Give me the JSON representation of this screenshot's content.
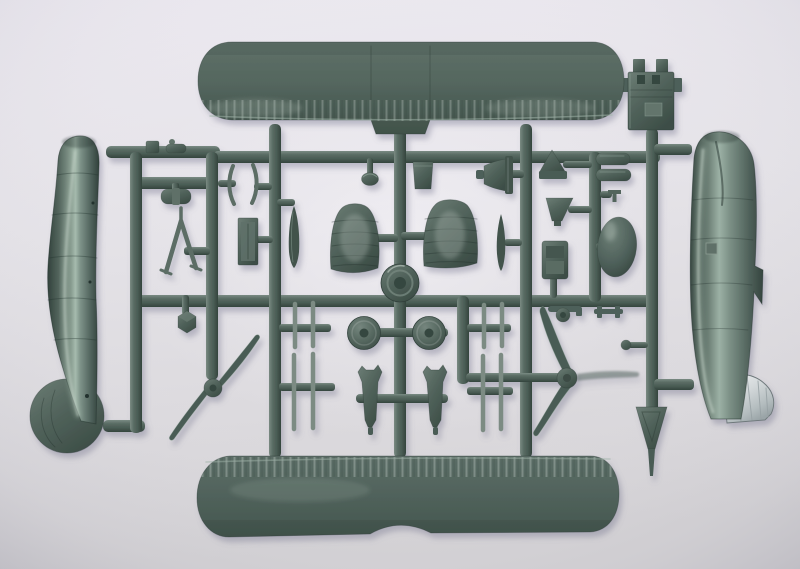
{
  "scene": {
    "type": "photograph",
    "subject": "Injection-moulded polystyrene sprue of 1/72-scale biplane model aircraft parts photographed on a pale grey background",
    "colors": {
      "background_top": "#ece9f0",
      "background_bottom": "#d5d3d6",
      "plastic_mid": "#51635c",
      "plastic_light": "#7a8b83",
      "plastic_dark": "#36463f",
      "plastic_deep": "#42534c",
      "plastic_highlight": "#a6bbae",
      "strut": "#7b8b83",
      "silver_part": "#d3d8da",
      "silver_edge": "#6d777a",
      "cast_shadow": "#6e6e88"
    },
    "parts": [
      {
        "id": "upper-wing",
        "label": "Upper wing, one piece with rounded tips"
      },
      {
        "id": "lower-wing",
        "label": "Lower wing, one piece with centre cut-out"
      },
      {
        "id": "fuselage-half-left",
        "label": "Port fuselage half with rounded fin"
      },
      {
        "id": "fuselage-half-right",
        "label": "Starboard fuselage half with fabric rudder"
      },
      {
        "id": "engine-block",
        "label": "Engine bulkhead block"
      },
      {
        "id": "two-blade-propeller",
        "label": "Two-blade propeller"
      },
      {
        "id": "three-blade-propeller",
        "label": "Three-blade propeller"
      },
      {
        "id": "tailplane-port",
        "label": "Port tailplane half"
      },
      {
        "id": "tailplane-starboard",
        "label": "Starboard tailplane half"
      },
      {
        "id": "cowling-ring",
        "label": "Cowling front ring"
      },
      {
        "id": "wheels",
        "label": "Two main wheels"
      },
      {
        "id": "gear-leg-fairings",
        "label": "Two undercarriage leg fairings"
      },
      {
        "id": "strut-sets",
        "label": "Paired interplane and cabane struts"
      },
      {
        "id": "spinner-cone",
        "label": "Propeller spinner"
      },
      {
        "id": "exhaust-stacks",
        "label": "Two exhaust stacks"
      },
      {
        "id": "headrest-fairing",
        "label": "Egg-shaped headrest fairing"
      },
      {
        "id": "pilot-seat",
        "label": "Pilot seat"
      },
      {
        "id": "tail-skid",
        "label": "Tapered tail skid"
      },
      {
        "id": "v-strut",
        "label": "V-form undercarriage strut"
      },
      {
        "id": "small-fittings",
        "label": "Assorted small fittings on the runners"
      }
    ]
  }
}
